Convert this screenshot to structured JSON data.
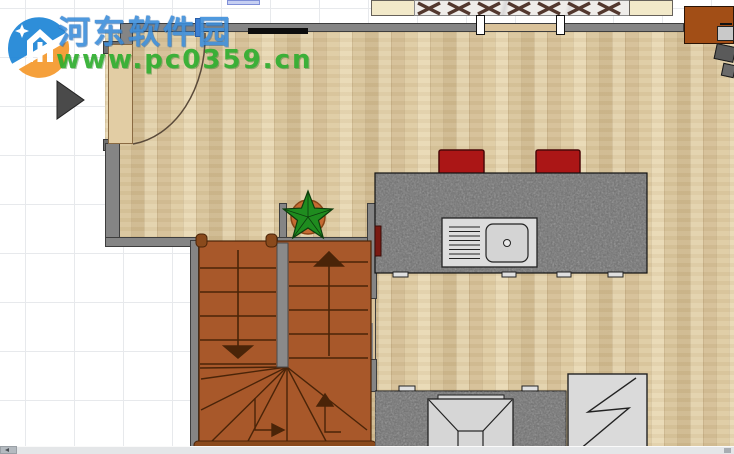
{
  "watermark": {
    "site_name": "河东软件园",
    "site_url": "www.pc0359.cn",
    "name_color": "#3d8edb",
    "url_color": "#2fae2f",
    "logo_blue": "#2388d8",
    "logo_orange": "#f59b31"
  },
  "plan": {
    "colors": {
      "floor": "#d8c298",
      "wall": "#858585",
      "window_fill": "#d9c29a",
      "granite": "#6e6e6e",
      "stair": "#a8582a",
      "stair_edge": "#4a2408",
      "stair_rail": "#8a4a1c",
      "stool_red": "#ab1616",
      "plant_green": "#1f8c1f",
      "pot_orange": "#c56a32",
      "door_tan": "#e2cda4",
      "cabinet_brown": "#a24e16",
      "appliance_gray": "#d6d6d6"
    },
    "items": [
      "door-with-swing-arc",
      "window",
      "wall-shelf",
      "dining-chairs-row",
      "window-sill-cabinets",
      "observer-marker",
      "potted-plant",
      "u-shaped-staircase",
      "stair-up-arrow",
      "stair-down-arrow",
      "kitchen-island",
      "sink-with-drainboard",
      "bar-stool-left",
      "bar-stool-right",
      "counter-with-range-hood",
      "refrigerator",
      "side-cabinet",
      "desk-chair"
    ]
  },
  "scrollbar": {
    "orientation": "horizontal"
  }
}
